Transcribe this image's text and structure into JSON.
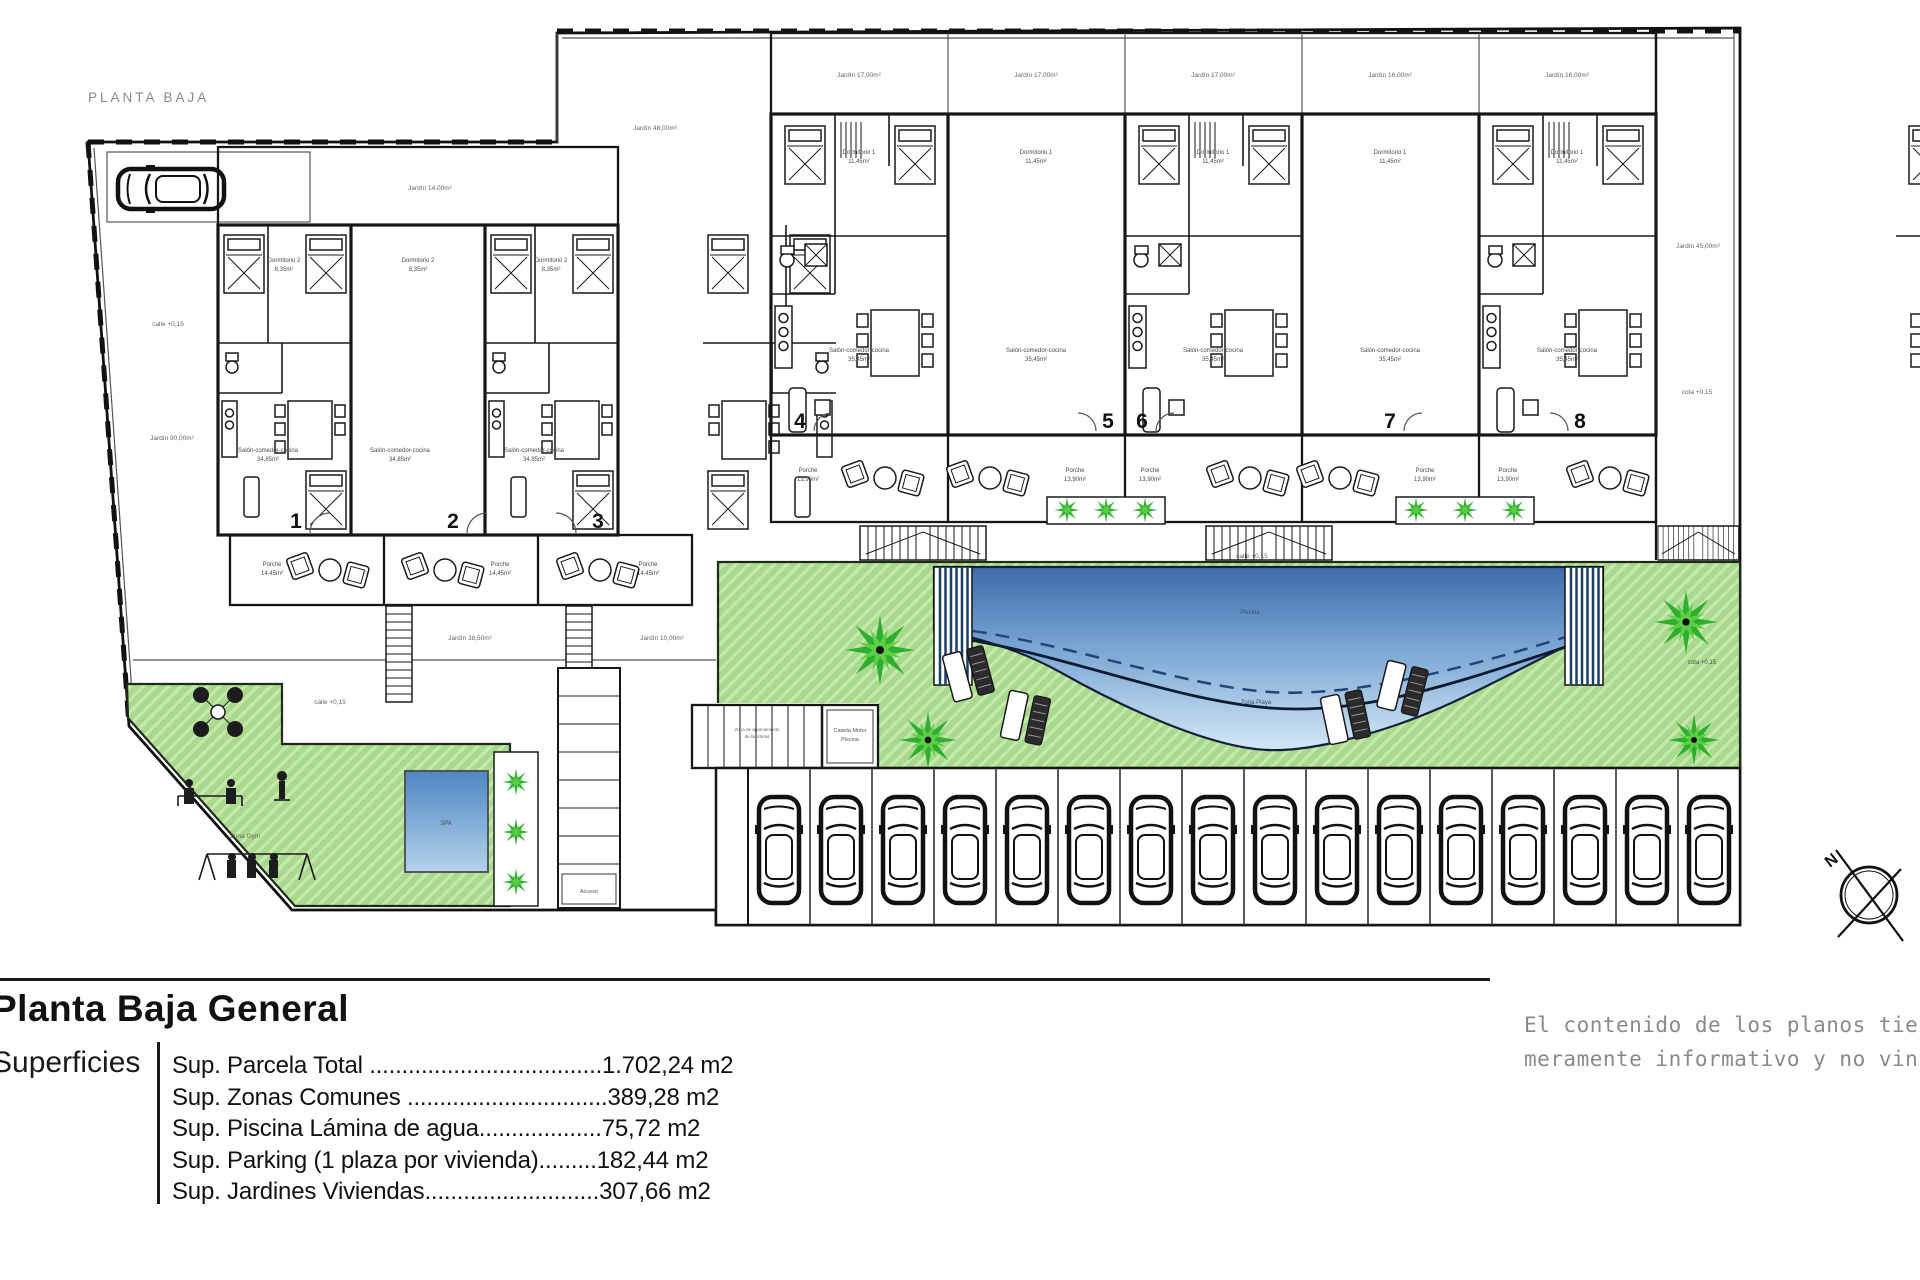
{
  "site": {
    "planta_label": "PLANTA BAJA",
    "calle_label": "calle +0,15",
    "cota_label": "cota +0,15",
    "spa_label": "SPA",
    "piscina_label": "Piscina",
    "zona_playa_label": "Zona Playa",
    "zona_gym_label": "Zona Gym",
    "caseta_line1": "Caseta Motor",
    "caseta_line2": "Piscina",
    "acceso_label": "Acceso",
    "bikes_line1": "Zona de aparcamiento",
    "bikes_line2": "de bicicletas",
    "north_label": "N",
    "jardin_90": "Jardín 90,00m²",
    "jardin_14": "Jardín 14,00m²",
    "jardin_48": "Jardín 48,00m²",
    "jardin_17": "Jardín 17,00m²",
    "jardin_16": "Jardín 16,00m²",
    "jardin_45": "Jardín 45,00m²",
    "jardin_38": "Jardín 38,50m²",
    "jardin_10": "Jardín 10,00m²"
  },
  "rooms": {
    "dorm1": "Dormitorio 1",
    "dorm1_area": "11,45m²",
    "dorm2": "Dormitorio 2",
    "dorm2_area": "8,35m²",
    "salon": "Salón-comedor-cocina",
    "salon_area": "35,45m²",
    "salon_area_left": "34,85m²",
    "porche": "Porche",
    "porche_area_left": "14,45m²",
    "porche_area_right": "13,90m²"
  },
  "units": [
    {
      "number": "1"
    },
    {
      "number": "2"
    },
    {
      "number": "3"
    },
    {
      "number": "4"
    },
    {
      "number": "5"
    },
    {
      "number": "6"
    },
    {
      "number": "7"
    },
    {
      "number": "8"
    }
  ],
  "legend": {
    "heading": "Planta Baja General",
    "superficies": "Superficies",
    "rows": [
      "Sup. Parcela Total ....................................1.702,24 m2",
      "Sup. Zonas Comunes ...............................389,28 m2",
      "Sup. Piscina Lámina de agua...................75,72 m2",
      "Sup. Parking (1 plaza por vivienda).........182,44 m2",
      "Sup. Jardines Viviendas...........................307,66 m2"
    ],
    "disclaimer_line1": "El contenido de los planos tiene valor",
    "disclaimer_line2": "meramente informativo y no vinculante"
  }
}
